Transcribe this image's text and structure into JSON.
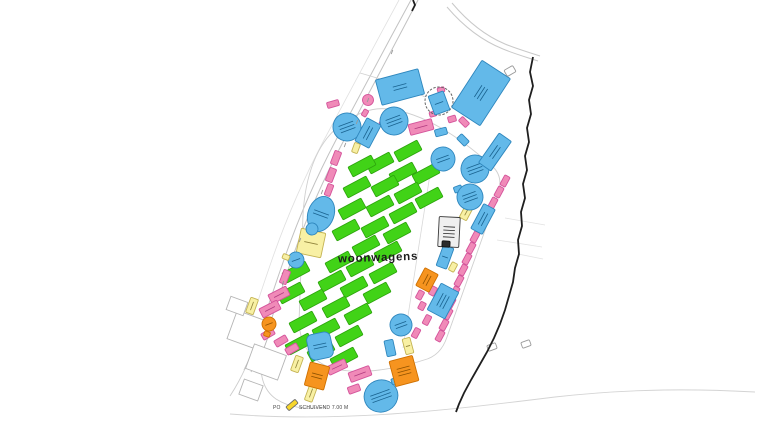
{
  "labels": {
    "woonwagens": "woonwagens",
    "gate_prefix": "PO",
    "gate_text": "SCHUIVEND 7.00 M"
  },
  "palette": {
    "green": {
      "f": "#41d317",
      "s": "#2ca30c",
      "m": "#1c7a06"
    },
    "pink": {
      "f": "#f08ab8",
      "s": "#d4549b",
      "m": "#b13c80"
    },
    "blue": {
      "f": "#63b9e9",
      "s": "#2e86bd",
      "m": "#19628f"
    },
    "orange": {
      "f": "#f6941f",
      "s": "#cf7000",
      "m": "#8f5200"
    },
    "yellow": {
      "f": "#f8f0a4",
      "s": "#c4b352",
      "m": "#8f823a"
    },
    "gold": {
      "f": "#f7d62c",
      "s": "#6b6b6b",
      "m": "#555555"
    },
    "grey": {
      "f": "#efefef",
      "s": "#3a3a3a",
      "m": "#222222"
    },
    "white": {
      "f": "#ffffff",
      "s": "#9a9a9a",
      "m": "#555555"
    },
    "dark": {
      "f": "#2b2b2b",
      "s": "#111111",
      "m": "#000000"
    }
  },
  "map_data": {
    "roads": [
      {
        "d": "M411,0 C385,48 357,100 336,140 C316,178 298,220 286,254 C276,282 267,310 258,336 C254,349 249,360 244,370",
        "w": 1,
        "c": "#c2c2c2"
      },
      {
        "d": "M418,0 C392,50 364,102 343,142 C323,180 305,222 293,256 C283,284 274,312 265,338 C261,351 256,362 251,372",
        "w": 1,
        "c": "#c2c2c2"
      },
      {
        "d": "M399,0 C373,48 345,100 324,140 C304,178 286,220 274,254 C264,282 256,308 248,330",
        "w": 0.8,
        "c": "#e0e0e0"
      },
      {
        "d": "M452,3 C468,22 486,36 505,44 C517,49 528,52 540,56",
        "w": 1,
        "c": "#c9c9c9"
      },
      {
        "d": "M447,7 C464,27 483,41 503,49 C515,54 526,57 538,61",
        "w": 1,
        "c": "#c9c9c9"
      },
      {
        "d": "M230,414 C340,423 450,410 555,397 C635,388 700,389 755,392",
        "w": 0.9,
        "c": "#d4d4d4"
      },
      {
        "d": "M253,350 C246,368 238,384 230,396",
        "w": 0.9,
        "c": "#cccccc"
      },
      {
        "d": "M262,356 C259,374 263,390 276,399 C290,408 308,410 325,407",
        "w": 0.9,
        "c": "#cccccc"
      },
      {
        "d": "M505,218 L545,225",
        "w": 0.8,
        "c": "#e2e2e2"
      },
      {
        "d": "M497,240 L542,247",
        "w": 0.8,
        "c": "#e2e2e2"
      },
      {
        "d": "M518,254 L543,259",
        "w": 0.8,
        "c": "#e2e2e2"
      },
      {
        "d": "M360,73 C385,80 408,88 425,97",
        "w": 0.9,
        "c": "#d0d0d0"
      },
      {
        "d": "M388,109 C425,113 463,140 492,166 C500,173 502,182 498,194 L447,337 C443,349 436,357 424,360 C400,368 360,376 332,368 C312,362 300,345 299,322 L303,215 C305,178 316,142 342,124 C357,113 372,107 388,109 Z",
        "w": 0.9,
        "c": "#cfcfcf"
      },
      {
        "d": "M433,155 L403,348",
        "w": 0.8,
        "c": "#d8d8d8"
      }
    ],
    "boundary": [
      {
        "d": "M533,57 L530,72 L533,86 L529,100 L531,114 L527,128 L529,142 L525,156 L527,170 L523,184 L525,198 L521,212 L522,226 L518,240 L519,254 L515,268 L513,282 L509,296 L505,310 L500,324 L494,338 L487,352 L479,366 L471,380 L464,393 L459,404 L456,412"
      },
      {
        "d": "M413,0 L415,5 L412,11"
      }
    ],
    "buildings": [
      {
        "x": 250,
        "y": 331,
        "w": 38,
        "h": 30,
        "r": 20
      },
      {
        "x": 266,
        "y": 362,
        "w": 34,
        "h": 26,
        "r": 20
      },
      {
        "x": 251,
        "y": 390,
        "w": 20,
        "h": 16,
        "r": 20
      },
      {
        "x": 237,
        "y": 306,
        "w": 18,
        "h": 14,
        "r": 20
      }
    ],
    "caravans": {
      "w": 26,
      "h": 11,
      "rot": -28,
      "centers": [
        [
          408,
          151
        ],
        [
          426,
          174
        ],
        [
          429,
          198
        ],
        [
          380,
          163
        ],
        [
          403,
          173
        ],
        [
          385,
          186
        ],
        [
          357,
          187
        ],
        [
          408,
          193
        ],
        [
          380,
          206
        ],
        [
          352,
          209
        ],
        [
          403,
          213
        ],
        [
          375,
          227
        ],
        [
          397,
          233
        ],
        [
          362,
          166
        ],
        [
          346,
          230
        ],
        [
          366,
          246
        ],
        [
          388,
          252
        ],
        [
          339,
          262
        ],
        [
          360,
          266
        ],
        [
          383,
          273
        ],
        [
          332,
          281
        ],
        [
          354,
          287
        ],
        [
          377,
          293
        ],
        [
          296,
          272
        ],
        [
          291,
          293
        ],
        [
          313,
          300
        ],
        [
          336,
          307
        ],
        [
          358,
          314
        ],
        [
          303,
          322
        ],
        [
          326,
          329
        ],
        [
          349,
          336
        ],
        [
          299,
          344
        ],
        [
          321,
          351
        ],
        [
          344,
          358
        ]
      ]
    },
    "shapes": [
      [
        "r",
        311,
        243,
        25,
        25,
        12,
        "yellow",
        1,
        "service-block"
      ],
      [
        "r",
        252,
        306,
        16,
        8,
        -70,
        "yellow",
        1,
        "service-block"
      ],
      [
        "r",
        297,
        364,
        16,
        8,
        -70,
        "yellow",
        1,
        "service-block"
      ],
      [
        "r",
        311,
        393,
        17,
        8,
        -70,
        "yellow",
        1,
        "service-block"
      ],
      [
        "r",
        292,
        405,
        12,
        5,
        -40,
        "gold",
        0,
        "gate-marker"
      ],
      [
        "r",
        356,
        148,
        10,
        6,
        -70,
        "yellow",
        0,
        "service-block"
      ],
      [
        "r",
        453,
        267,
        9,
        6,
        -62,
        "yellow",
        0,
        "service-block"
      ],
      [
        "r",
        467,
        211,
        18,
        8,
        -62,
        "yellow",
        1,
        "service-block"
      ],
      [
        "r",
        408,
        346,
        8,
        16,
        -15,
        "yellow",
        1,
        "service-block"
      ],
      [
        "c",
        368,
        100,
        5.5,
        0,
        -20,
        "pink",
        0,
        "kiosk-circle"
      ],
      [
        "r",
        421,
        127,
        24,
        11,
        -15,
        "pink",
        1,
        "market-stall"
      ],
      [
        "r",
        452,
        119,
        8,
        6,
        -16,
        "pink",
        0,
        "market-stall"
      ],
      [
        "r",
        383,
        121,
        8,
        5,
        -60,
        "pink",
        0,
        "market-stall"
      ],
      [
        "r",
        365,
        113,
        7,
        5,
        -60,
        "pink",
        0,
        "market-stall"
      ],
      [
        "r",
        333,
        104,
        12,
        6,
        -16,
        "pink",
        0,
        "market-stall"
      ],
      [
        "r",
        336,
        158,
        14,
        7,
        -69,
        "pink",
        0,
        "market-stall"
      ],
      [
        "r",
        331,
        175,
        14,
        7,
        -69,
        "pink",
        0,
        "market-stall"
      ],
      [
        "r",
        329,
        190,
        12,
        6,
        -69,
        "pink",
        0,
        "market-stall"
      ],
      [
        "r",
        285,
        277,
        14,
        7,
        -69,
        "pink",
        0,
        "market-stall"
      ],
      [
        "r",
        279,
        295,
        20,
        10,
        -27,
        "pink",
        1,
        "market-stall"
      ],
      [
        "r",
        270,
        309,
        20,
        10,
        -27,
        "pink",
        1,
        "market-stall"
      ],
      [
        "r",
        268,
        334,
        13,
        7,
        -30,
        "pink",
        0,
        "market-stall"
      ],
      [
        "r",
        281,
        341,
        13,
        7,
        -30,
        "pink",
        0,
        "market-stall"
      ],
      [
        "r",
        292,
        349,
        13,
        7,
        -30,
        "pink",
        0,
        "market-stall"
      ],
      [
        "r",
        337,
        367,
        20,
        9,
        -25,
        "pink",
        1,
        "market-stall"
      ],
      [
        "r",
        360,
        374,
        22,
        10,
        -20,
        "pink",
        1,
        "market-stall"
      ],
      [
        "r",
        354,
        389,
        12,
        7,
        -20,
        "pink",
        0,
        "market-stall"
      ],
      [
        "r",
        376,
        385,
        10,
        6,
        -20,
        "pink",
        0,
        "market-stall"
      ],
      [
        "r",
        464,
        122,
        10,
        6,
        45,
        "pink",
        0,
        "market-stall"
      ],
      [
        "r",
        486,
        104,
        8,
        5,
        45,
        "pink",
        0,
        "market-stall"
      ],
      [
        "r",
        441,
        90,
        7,
        5,
        -16,
        "pink",
        0,
        "market-stall"
      ],
      [
        "r",
        433,
        114,
        7,
        5,
        -16,
        "pink",
        0,
        "market-stall"
      ],
      [
        "r",
        505,
        181,
        11,
        6,
        -62,
        "pink",
        0,
        "market-stall"
      ],
      [
        "r",
        499,
        192,
        11,
        6,
        -62,
        "pink",
        0,
        "market-stall"
      ],
      [
        "r",
        493,
        203,
        11,
        6,
        -62,
        "pink",
        0,
        "market-stall"
      ],
      [
        "r",
        475,
        237,
        11,
        6,
        -62,
        "pink",
        0,
        "market-stall"
      ],
      [
        "r",
        471,
        248,
        11,
        6,
        -62,
        "pink",
        0,
        "market-stall"
      ],
      [
        "r",
        467,
        259,
        11,
        6,
        -62,
        "pink",
        0,
        "market-stall"
      ],
      [
        "r",
        463,
        270,
        11,
        6,
        -62,
        "pink",
        0,
        "market-stall"
      ],
      [
        "r",
        459,
        281,
        11,
        6,
        -62,
        "pink",
        0,
        "market-stall"
      ],
      [
        "r",
        455,
        292,
        11,
        6,
        -62,
        "pink",
        0,
        "market-stall"
      ],
      [
        "r",
        451,
        303,
        11,
        6,
        -62,
        "pink",
        0,
        "market-stall"
      ],
      [
        "r",
        448,
        314,
        11,
        6,
        -62,
        "pink",
        0,
        "market-stall"
      ],
      [
        "r",
        444,
        325,
        11,
        6,
        -62,
        "pink",
        0,
        "market-stall"
      ],
      [
        "r",
        440,
        336,
        11,
        6,
        -62,
        "pink",
        0,
        "market-stall"
      ],
      [
        "r",
        433,
        291,
        9,
        6,
        -62,
        "pink",
        0,
        "market-stall"
      ],
      [
        "r",
        420,
        295,
        9,
        6,
        -62,
        "pink",
        0,
        "market-stall"
      ],
      [
        "r",
        422,
        306,
        8,
        6,
        -62,
        "pink",
        0,
        "market-stall"
      ],
      [
        "r",
        427,
        320,
        10,
        6,
        -62,
        "pink",
        0,
        "market-stall"
      ],
      [
        "r",
        416,
        333,
        10,
        6,
        -62,
        "pink",
        0,
        "market-stall"
      ],
      [
        "r",
        400,
        87,
        44,
        26,
        -15,
        "blue",
        2,
        "ride-block"
      ],
      [
        "ring",
        439,
        101,
        14,
        0,
        0,
        "blue",
        0,
        "ride-ring"
      ],
      [
        "r",
        439,
        103,
        16,
        20,
        -20,
        "blue",
        1,
        "ride-block"
      ],
      [
        "r",
        441,
        132,
        12,
        7,
        -15,
        "blue",
        0,
        "ride-block"
      ],
      [
        "r",
        481,
        93,
        56,
        34,
        -57,
        "blue",
        3,
        "ride-block"
      ],
      [
        "c",
        394,
        121,
        14,
        0,
        -20,
        "blue",
        3,
        "ride-circle"
      ],
      [
        "c",
        347,
        127,
        14,
        0,
        -20,
        "blue",
        3,
        "ride-circle"
      ],
      [
        "r",
        368,
        133,
        26,
        16,
        -62,
        "blue",
        2,
        "ride-block"
      ],
      [
        "c",
        443,
        159,
        12,
        0,
        -20,
        "blue",
        2,
        "ride-circle"
      ],
      [
        "c",
        475,
        169,
        14,
        0,
        -20,
        "blue",
        3,
        "ride-circle"
      ],
      [
        "r",
        458,
        189,
        8,
        6,
        -20,
        "blue",
        0,
        "ride-block"
      ],
      [
        "c",
        470,
        197,
        13,
        0,
        -20,
        "blue",
        3,
        "ride-circle"
      ],
      [
        "r",
        495,
        152,
        36,
        15,
        -55,
        "blue",
        2,
        "ride-block"
      ],
      [
        "e",
        321,
        214,
        26,
        36,
        20,
        "blue",
        2,
        "ride-oval"
      ],
      [
        "c",
        312,
        229,
        6,
        0,
        -20,
        "blue",
        0,
        "ride-circle"
      ],
      [
        "c",
        296,
        260,
        8,
        0,
        -20,
        "blue",
        1,
        "ride-circle"
      ],
      [
        "r",
        286,
        257,
        5,
        7,
        -69,
        "yellow",
        0,
        "service-block"
      ],
      [
        "r",
        483,
        219,
        28,
        13,
        -62,
        "blue",
        2,
        "ride-block"
      ],
      [
        "r",
        445,
        257,
        11,
        22,
        20,
        "blue",
        1,
        "ride-block"
      ],
      [
        "r",
        443,
        301,
        30,
        20,
        -62,
        "blue",
        3,
        "ride-block"
      ],
      [
        "c",
        401,
        325,
        11,
        0,
        -20,
        "blue",
        2,
        "ride-circle"
      ],
      [
        "r",
        320,
        346,
        24,
        26,
        -12,
        "blue",
        2,
        "ride-block",
        6
      ],
      [
        "e",
        381,
        396,
        34,
        32,
        -20,
        "blue",
        3,
        "ride-oval"
      ],
      [
        "r",
        395,
        381,
        7,
        6,
        -20,
        "blue",
        0,
        "ride-block"
      ],
      [
        "r",
        390,
        348,
        9,
        16,
        -12,
        "blue",
        0,
        "ride-block"
      ],
      [
        "r",
        463,
        140,
        11,
        7,
        45,
        "blue",
        0,
        "ride-block"
      ],
      [
        "r",
        427,
        280,
        20,
        15,
        -62,
        "orange",
        2,
        "attraction-block"
      ],
      [
        "r",
        317,
        376,
        20,
        24,
        15,
        "orange",
        2,
        "attraction-block"
      ],
      [
        "r",
        404,
        371,
        24,
        26,
        -15,
        "orange",
        3,
        "attraction-block"
      ],
      [
        "c",
        269,
        324,
        7,
        0,
        -20,
        "orange",
        1,
        "attraction-circle"
      ],
      [
        "r",
        267,
        334,
        6,
        5,
        20,
        "orange",
        0,
        "attraction-block"
      ],
      [
        "r",
        449,
        232,
        21,
        30,
        3,
        "grey",
        4,
        "facility-building"
      ],
      [
        "r",
        446,
        244,
        8,
        6,
        3,
        "dark",
        0,
        "facility-detail"
      ],
      [
        "r",
        510,
        71,
        10,
        7,
        -30,
        "white",
        0,
        "gate-rect"
      ],
      [
        "r",
        492,
        347,
        9,
        6,
        -20,
        "white",
        0,
        "gate-rect"
      ],
      [
        "r",
        526,
        344,
        9,
        6,
        -20,
        "white",
        0,
        "gate-rect"
      ]
    ],
    "ticks": [
      [
        392,
        52
      ],
      [
        368,
        100
      ],
      [
        345,
        145
      ],
      [
        322,
        192
      ],
      [
        300,
        240
      ],
      [
        283,
        283
      ],
      [
        357,
        122
      ]
    ],
    "label_pos": {
      "woonwagens": {
        "x": 338,
        "y": 261,
        "rot": -2,
        "cx": 380,
        "cy": 257
      },
      "gate_prefix": {
        "x": 273,
        "y": 409
      },
      "gate_text": {
        "x": 299,
        "y": 409
      }
    }
  }
}
